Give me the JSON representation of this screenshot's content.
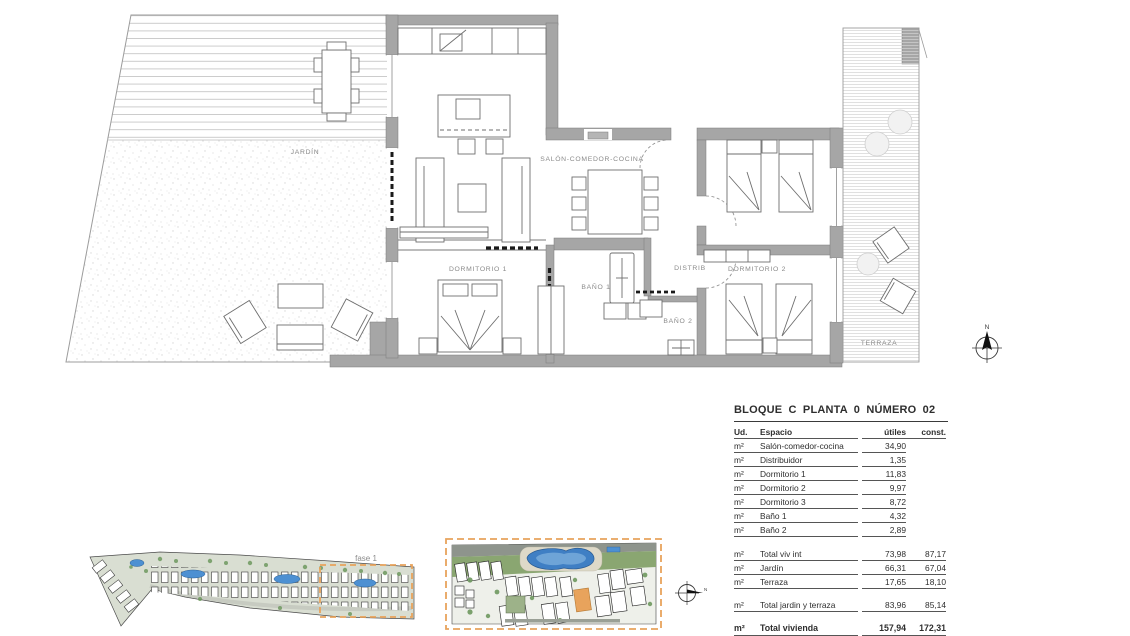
{
  "plan": {
    "rooms": {
      "jardin": "JARDÍN",
      "salon": "SALÓN-COMEDOR-COCINA",
      "dormitorio1": "DORMITORIO 1",
      "bano1": "BAÑO 1",
      "distrib": "DISTRIB",
      "bano2": "BAÑO 2",
      "dormitorio2": "DORMITORIO 2",
      "terraza": "TERRAZA"
    },
    "compass_label": "N"
  },
  "site": {
    "fase_label": "fase 1",
    "compass_label": "N"
  },
  "summary": {
    "title": "BLOQUE C  PLANTA 0  NÚMERO 02",
    "columns": {
      "ud": "Ud.",
      "espacio": "Espacio",
      "utiles": "útiles",
      "const": "const."
    },
    "rows": [
      {
        "ud": "m²",
        "espacio": "Salón-comedor-cocina",
        "utiles": "34,90",
        "const": ""
      },
      {
        "ud": "m²",
        "espacio": "Distribuidor",
        "utiles": "1,35",
        "const": ""
      },
      {
        "ud": "m²",
        "espacio": "Dormitorio 1",
        "utiles": "11,83",
        "const": ""
      },
      {
        "ud": "m²",
        "espacio": "Dormitorio 2",
        "utiles": "9,97",
        "const": ""
      },
      {
        "ud": "m²",
        "espacio": "Dormitorio 3",
        "utiles": "8,72",
        "const": ""
      },
      {
        "ud": "m²",
        "espacio": "Baño 1",
        "utiles": "4,32",
        "const": ""
      },
      {
        "ud": "m²",
        "espacio": "Baño 2",
        "utiles": "2,89",
        "const": ""
      },
      {
        "ud": "m²",
        "espacio": "Total viv int",
        "utiles": "73,98",
        "const": "87,17"
      },
      {
        "ud": "m²",
        "espacio": "Jardín",
        "utiles": "66,31",
        "const": "67,04"
      },
      {
        "ud": "m²",
        "espacio": "Terraza",
        "utiles": "17,65",
        "const": "18,10"
      },
      {
        "ud": "m²",
        "espacio": "Total jardin y terraza",
        "utiles": "83,96",
        "const": "85,14"
      },
      {
        "ud": "m²",
        "espacio": "Total vivienda",
        "utiles": "157,94",
        "const": "172,31"
      }
    ]
  },
  "colors": {
    "phase_accent_orange": "#e8a35c",
    "pool_blue": "#4d90d2",
    "wall_gray": "#a6a6a6",
    "landscape_green": "#6f9960"
  }
}
